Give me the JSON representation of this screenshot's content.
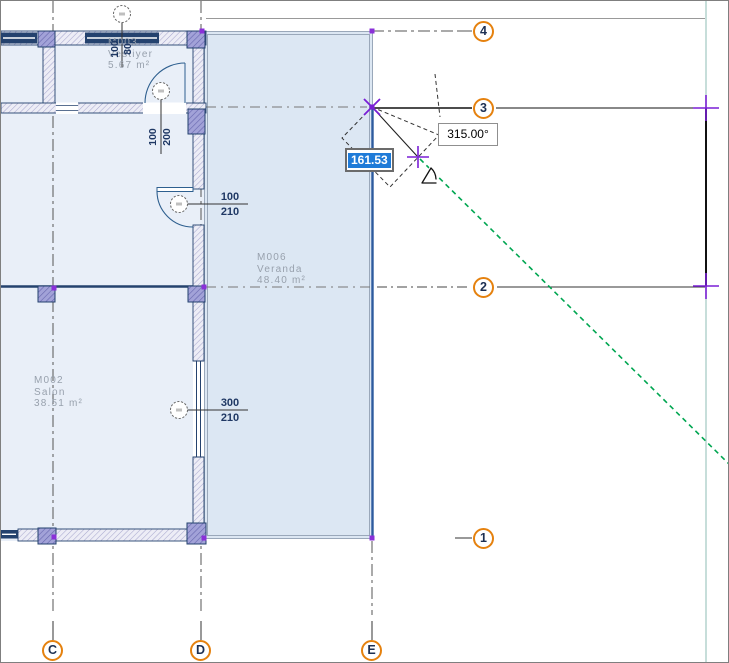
{
  "drawing": {
    "type": "architectural-floor-plan"
  },
  "tracker": {
    "distance_value": "161.53",
    "angle_value": "315.00°"
  },
  "grid": {
    "vertical_axes": [
      {
        "label": "C"
      },
      {
        "label": "D"
      },
      {
        "label": "E"
      }
    ],
    "horizontal_axes": [
      {
        "label": "4"
      },
      {
        "label": "3"
      },
      {
        "label": "2"
      },
      {
        "label": "1"
      }
    ]
  },
  "rooms": [
    {
      "id": "M003",
      "name": "Vestiyer",
      "area": "5.67 m²"
    },
    {
      "id": "M002",
      "name": "Salon",
      "area": "38.51 m²"
    },
    {
      "id": "M006",
      "name": "Veranda",
      "area": "48.40 m²"
    }
  ],
  "openings": [
    {
      "kind": "window",
      "width": "100",
      "height": "80"
    },
    {
      "kind": "door",
      "width": "100",
      "height": "200"
    },
    {
      "kind": "door",
      "width": "100",
      "height": "210"
    },
    {
      "kind": "window",
      "width": "300",
      "height": "210"
    }
  ],
  "colors": {
    "selection_purple": "#7a1fd6",
    "grid_bubble_orange": "#e5810e",
    "guide_green": "#00a651",
    "tracker_selection_blue": "#1f7bd8",
    "wall_navy": "#24426e",
    "veranda_fill": "#dce7f3",
    "room_fill": "#e9eff8"
  }
}
